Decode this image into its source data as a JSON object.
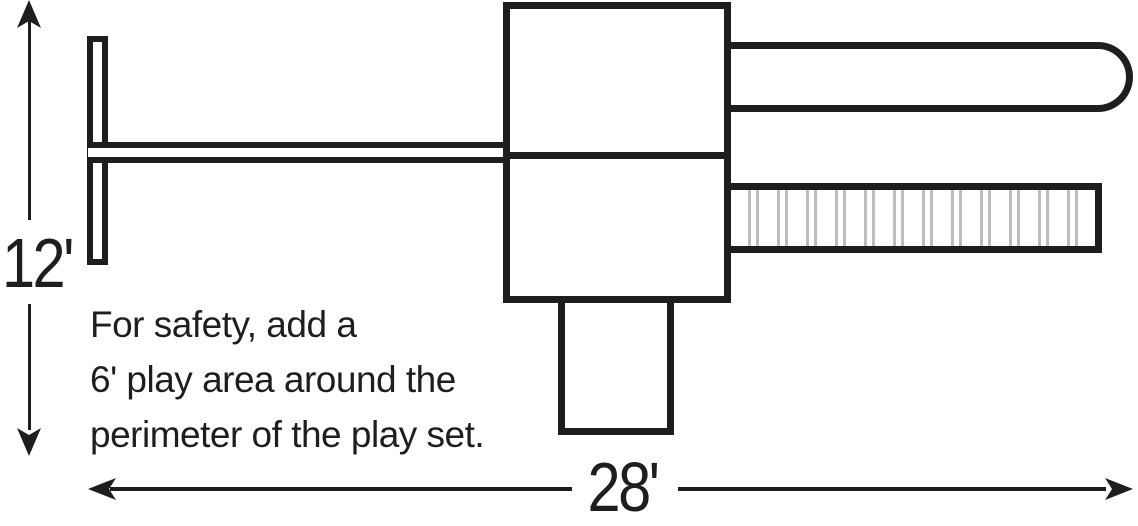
{
  "figure": {
    "title": "play set plan with safety dimensions",
    "background_color": "#ffffff",
    "line_color": "#1e1e1e",
    "ladder_rung_color": "#bdbdbd"
  },
  "dimensions": {
    "height_label": "12'",
    "width_label": "28'"
  },
  "note": {
    "lines": [
      "For safety, add a",
      "6' play area around the",
      "perimeter of the play set."
    ]
  },
  "play_set": {
    "ladder": {
      "rung_count": 12
    }
  }
}
